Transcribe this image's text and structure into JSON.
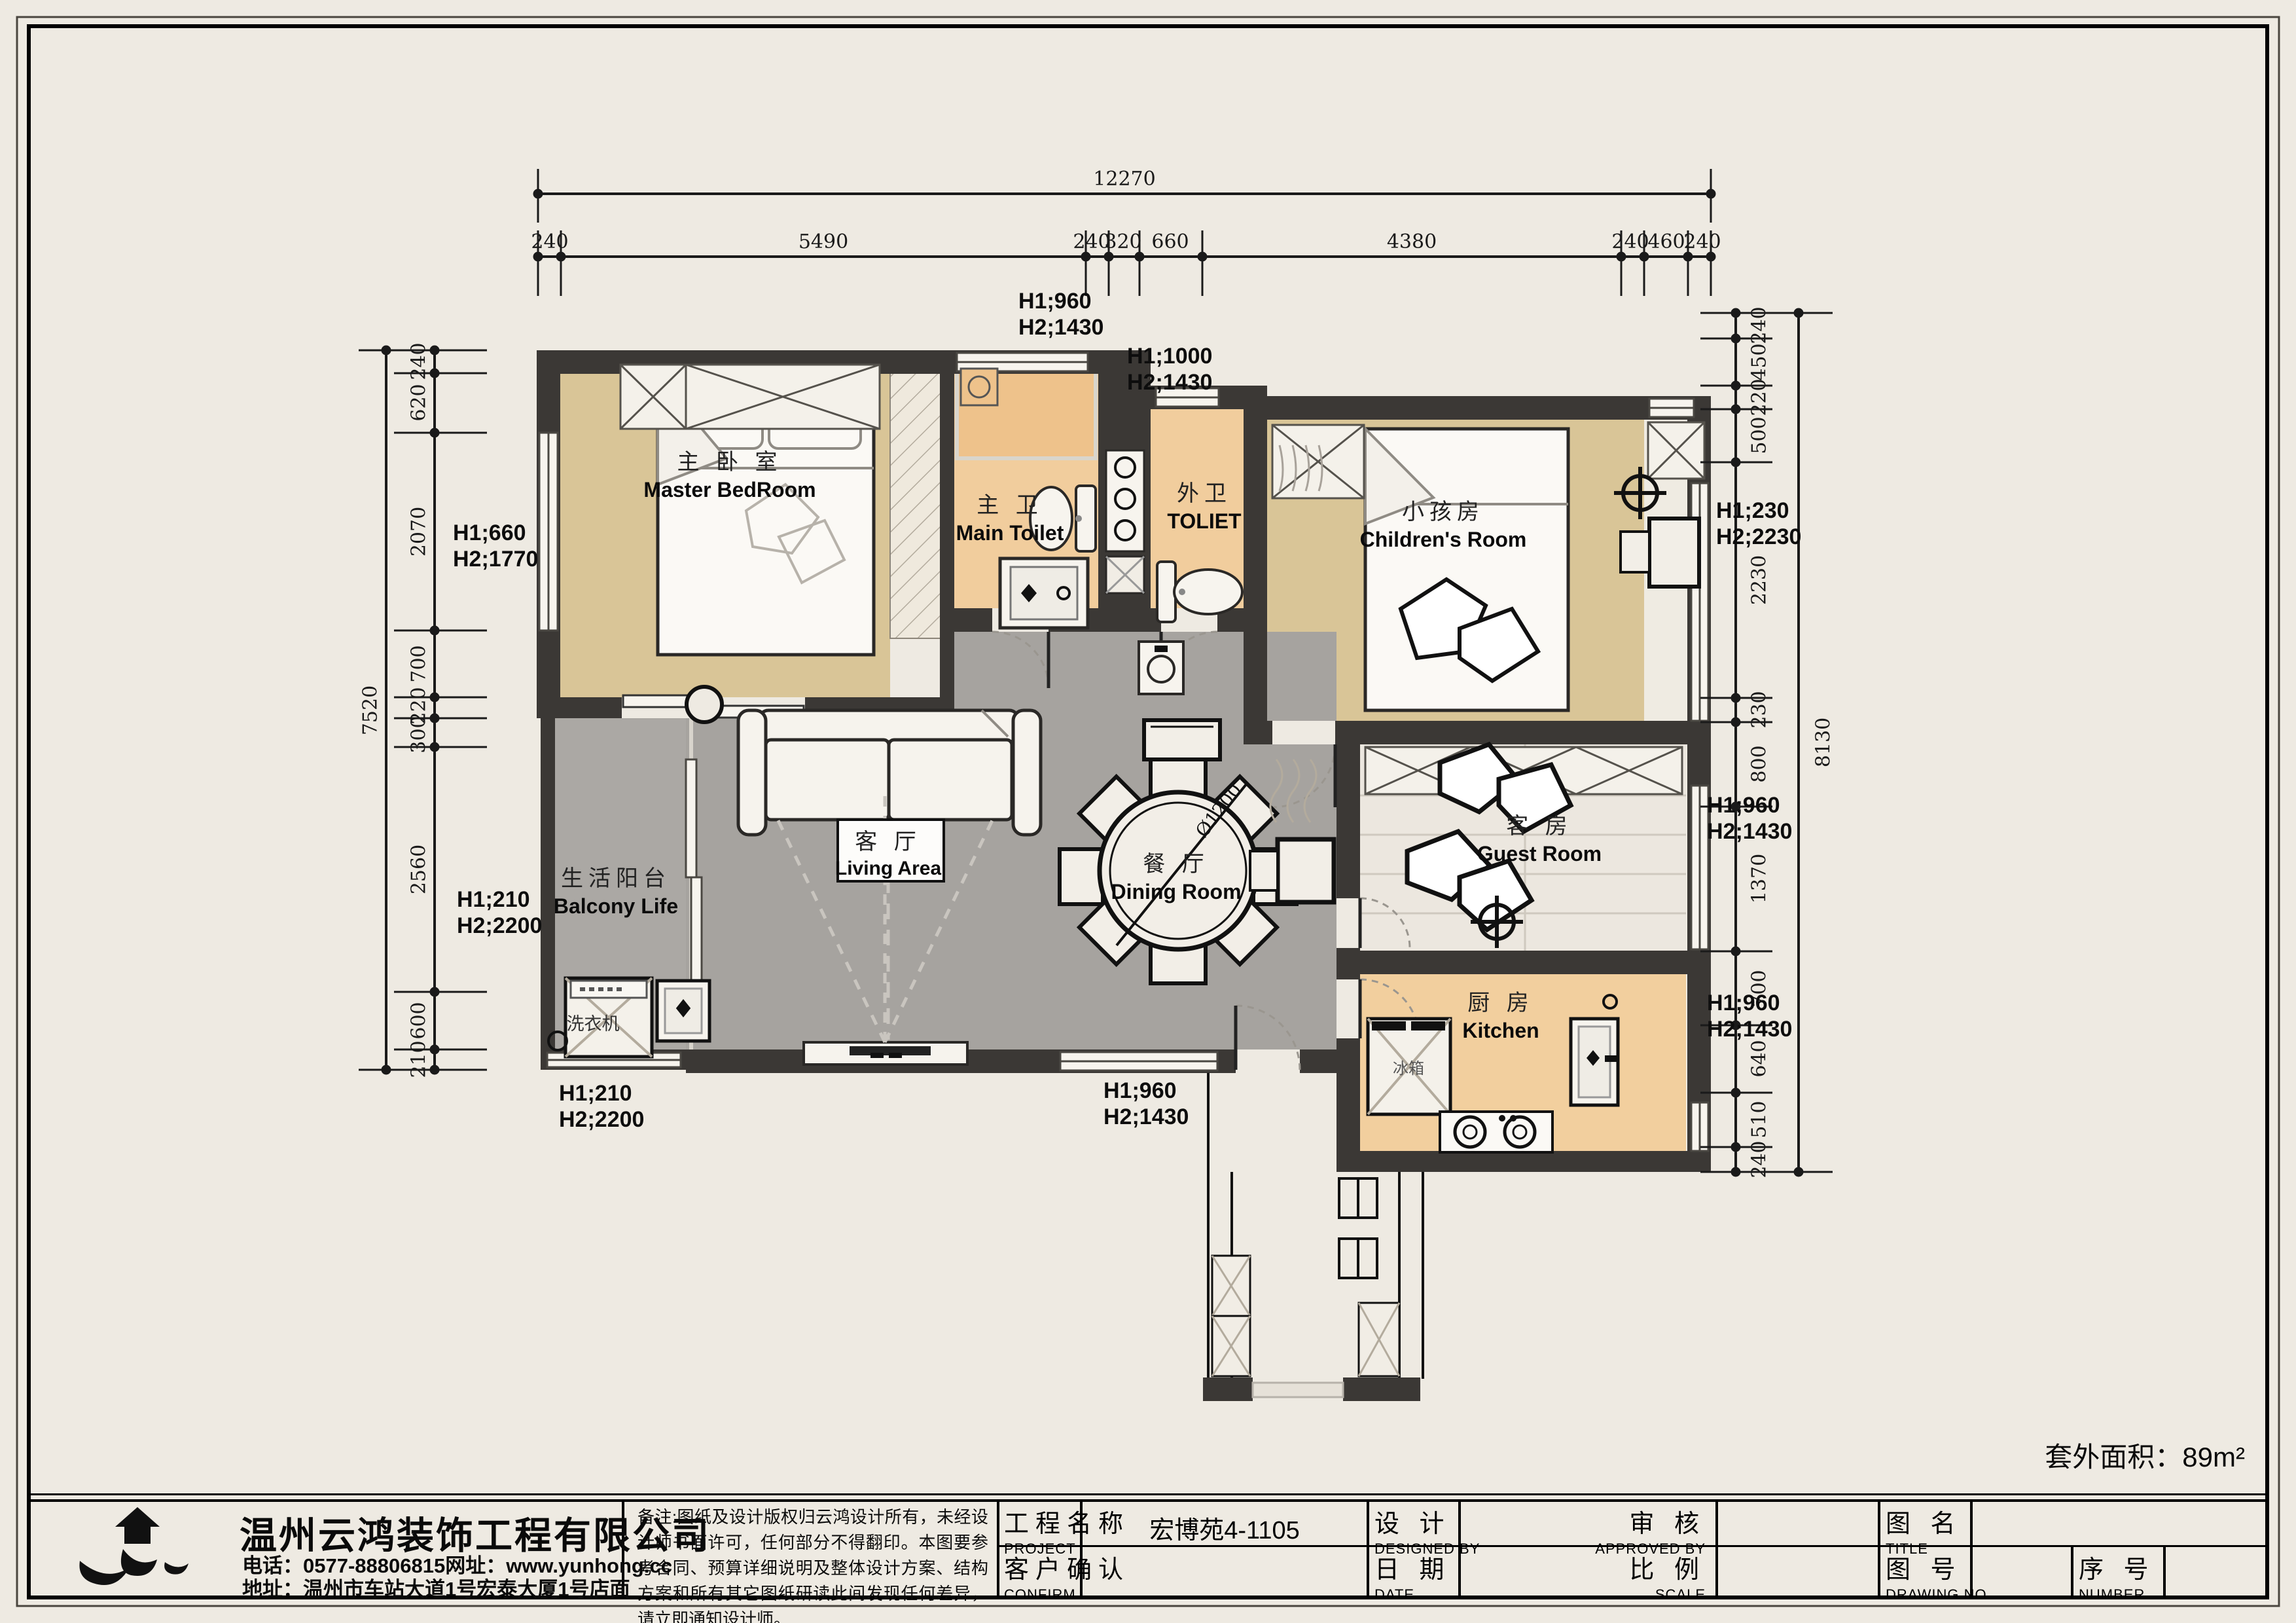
{
  "plan": {
    "rooms": {
      "master": {
        "cn": "主 卧 室",
        "en": "Master BedRoom"
      },
      "main_toilet": {
        "cn": "主 卫",
        "en": "Main Toilet"
      },
      "toilet": {
        "cn": "外卫",
        "en": "TOLIET"
      },
      "children": {
        "cn": "小孩房",
        "en": "Children's Room"
      },
      "balcony": {
        "cn": "生活阳台",
        "en": "Balcony Life"
      },
      "living": {
        "cn": "客 厅",
        "en": "Living Area"
      },
      "dining": {
        "cn": "餐 厅",
        "en": "Dining Room"
      },
      "guest": {
        "cn": "客 房",
        "en": "Guest Room"
      },
      "kitchen": {
        "cn": "厨 房",
        "en": "Kitchen"
      }
    },
    "labels": {
      "washer": "洗衣机",
      "fridge": "冰箱",
      "table_diameter": "Ø1200",
      "area_note": "套外面积：89m²"
    },
    "annotations": [
      {
        "l1": "H1;960",
        "l2": "H2;1430"
      },
      {
        "l1": "H1;1000",
        "l2": "H2;1430"
      },
      {
        "l1": "H1;660",
        "l2": "H2;1770"
      },
      {
        "l1": "H1;210",
        "l2": "H2;2200"
      },
      {
        "l1": "H1;230",
        "l2": "H2;2230"
      },
      {
        "l1": "H1;960",
        "l2": "H2;1430"
      },
      {
        "l1": "H1;960",
        "l2": "H2;1430"
      },
      {
        "l1": "H1;210",
        "l2": "H2;2200"
      },
      {
        "l1": "H1;960",
        "l2": "H2;1430"
      }
    ]
  },
  "dimensions": {
    "top": {
      "total": "12270",
      "segments": [
        "240",
        "5490",
        "240",
        "320",
        "660",
        "4380",
        "240",
        "460",
        "240"
      ]
    },
    "left": {
      "total": "7520",
      "segments": [
        "240",
        "620",
        "2070",
        "700",
        "220",
        "300",
        "2560",
        "600",
        "210"
      ]
    },
    "right": {
      "total": "8130",
      "segments": [
        "240",
        "450",
        "220",
        "500",
        "2230",
        "230",
        "800",
        "1370",
        "700",
        "640",
        "510",
        "240"
      ]
    }
  },
  "titleblock": {
    "company": {
      "name": "温州云鸿装饰工程有限公司",
      "phone": "电话：0577-88806815网址：www.yunhong.cc",
      "address": "地址：温州市车站大道1号宏泰大厦1号店面"
    },
    "notes": "备注:图纸及设计版权归云鸿设计所有，未经设计师书面许可，任何部分不得翻印。本图要参考合同、预算详细说明及整体设计方案、结构方案和所有其它图纸研读此间发现任何差异，请立即通知设计师。",
    "fields": {
      "project_cn": "工程名称",
      "project_en": "PROJECT",
      "confirm_cn": "客户确认",
      "confirm_en": "CONFIRM",
      "design_cn": "设 计",
      "design_en": "DESIGNED BY",
      "date_cn": "日 期",
      "date_en": "DATE",
      "approve_cn": "审 核",
      "approve_en": "APPROVED BY",
      "scale_cn": "比 例",
      "scale_en": "SCALE",
      "title_cn": "图 名",
      "title_en": "TITLE",
      "drawing_cn": "图 号",
      "drawing_en": "DRAWING NO",
      "number_cn": "序 号",
      "number_en": "NUMBER"
    },
    "values": {
      "project": "宏博苑4-1105"
    }
  }
}
